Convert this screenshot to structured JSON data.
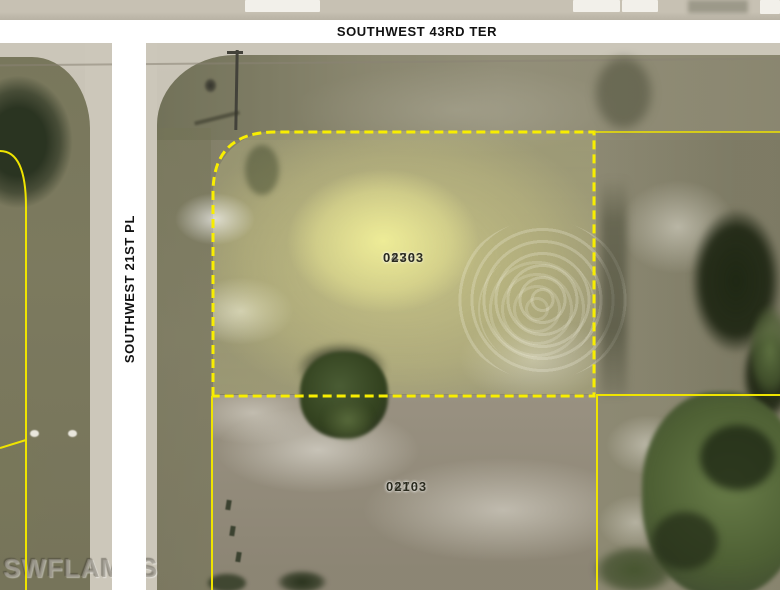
{
  "map": {
    "streets": {
      "horizontal": {
        "label": "SOUTHWEST 43RD TER"
      },
      "vertical": {
        "label": "SOUTHWEST 21ST PL"
      }
    },
    "parcels": [
      {
        "id": "highlighted-lot",
        "line1": "04763",
        "line2": "0230",
        "boundary": "dashed-yellow",
        "highlighted": true
      },
      {
        "id": "south-lot",
        "line1": "04763",
        "line2": "0210",
        "boundary": "solid-yellow",
        "highlighted": false
      }
    ],
    "partial_labels_east": [
      {
        "line1": "04",
        "line2": "02"
      },
      {
        "line1": "04",
        "line2": "02"
      }
    ],
    "watermark": "SWFLAMLS",
    "colors": {
      "boundary_yellow": "#f8ee00",
      "highlight_fill": "#dcd998",
      "street_band": "#ffffff",
      "label_text": "#2b2b1e",
      "pavement": "#cbc6b9",
      "scrub": "#8d8973",
      "grass": "#7d7b60",
      "pine_dark": "#1f2814",
      "pine_green": "#5d7040"
    }
  }
}
